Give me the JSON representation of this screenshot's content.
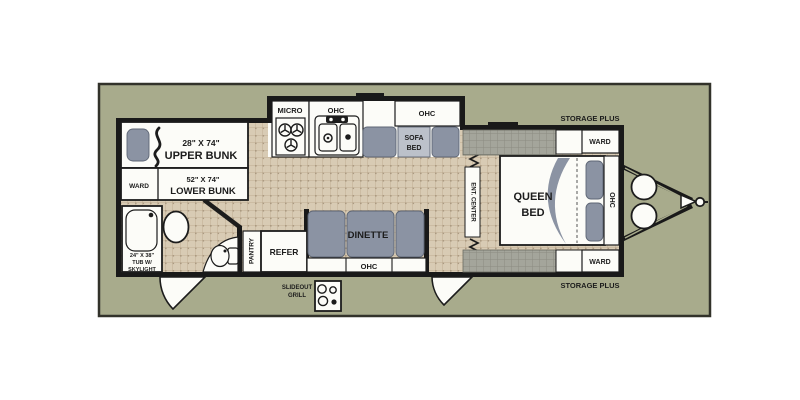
{
  "figure": {
    "type": "travel-trailer-floorplan"
  },
  "colors": {
    "page_background": "#ffffff",
    "photo_background": "#a8ab8c",
    "photo_border": "#32322a",
    "wall": "#191919",
    "floor_tile": "#d8cbb4",
    "floor_grid": "#c0ad92",
    "storage_hatch": "#a4a59b",
    "furniture_gray": "#8b93a3",
    "fixture_white": "#fcfcf8",
    "text": "#1c1c1c"
  },
  "labels": {
    "upper_bunk_size": "28\" X 74\"",
    "upper_bunk": "UPPER BUNK",
    "lower_bunk_size": "52\" X 74\"",
    "lower_bunk": "LOWER BUNK",
    "ward": "WARD",
    "tub_size": "24\" X 38\"",
    "tub_mid": "TUB W/",
    "tub_bottom": "SKYLIGHT",
    "pantry": "PANTRY",
    "refer": "REFER",
    "dinette": "DINETTE",
    "ohc": "OHC",
    "micro": "MICRO",
    "sofa_top": "SOFA",
    "sofa_bottom": "BED",
    "ent_center": "ENT. CENTER",
    "queen_top": "QUEEN",
    "queen_bottom": "BED",
    "storage_plus": "STORAGE PLUS",
    "slideout_top": "SLIDEOUT",
    "slideout_bottom": "GRILL"
  }
}
